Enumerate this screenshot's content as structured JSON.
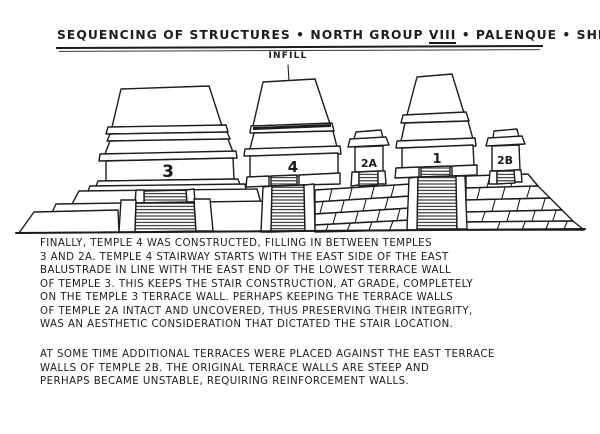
{
  "title": {
    "part1": "SEQUENCING OF STRUCTURES • NORTH GROUP ",
    "roman": "VIII",
    "part2": " • PALENQUE • SHEET 3"
  },
  "drawing": {
    "infill_label": "INFILL",
    "temple_labels": {
      "t3": "3",
      "t4": "4",
      "t2a": "2A",
      "t1": "1",
      "t2b": "2B"
    }
  },
  "paragraphs": {
    "p1": {
      "lines": [
        "FINALLY, TEMPLE 4 WAS CONSTRUCTED, FILLING IN BETWEEN TEMPLES",
        "3 AND 2A. TEMPLE 4 STAIRWAY STARTS WITH THE EAST SIDE OF THE EAST",
        "BALUSTRADE IN LINE WITH THE EAST END OF THE LOWEST TERRACE WALL",
        "OF TEMPLE 3. THIS KEEPS THE STAIR CONSTRUCTION, AT GRADE, COMPLETELY",
        "ON THE TEMPLE 3 TERRACE WALL. PERHAPS KEEPING THE TERRACE WALLS",
        "OF TEMPLE 2A INTACT AND UNCOVERED, THUS PRESERVING THEIR INTEGRITY,",
        "WAS AN AESTHETIC CONSIDERATION THAT DICTATED THE STAIR LOCATION."
      ]
    },
    "p2": {
      "lines": [
        "AT SOME TIME  ADDITIONAL TERRACES WERE PLACED AGAINST THE EAST TERRACE",
        "WALLS OF TEMPLE 2B. THE ORIGINAL TERRACE WALLS ARE STEEP AND",
        "PERHAPS BECAME UNSTABLE, REQUIRING REINFORCEMENT WALLS."
      ]
    }
  },
  "colors": {
    "ink": "#1c1c1c",
    "paper": "#ffffff"
  }
}
